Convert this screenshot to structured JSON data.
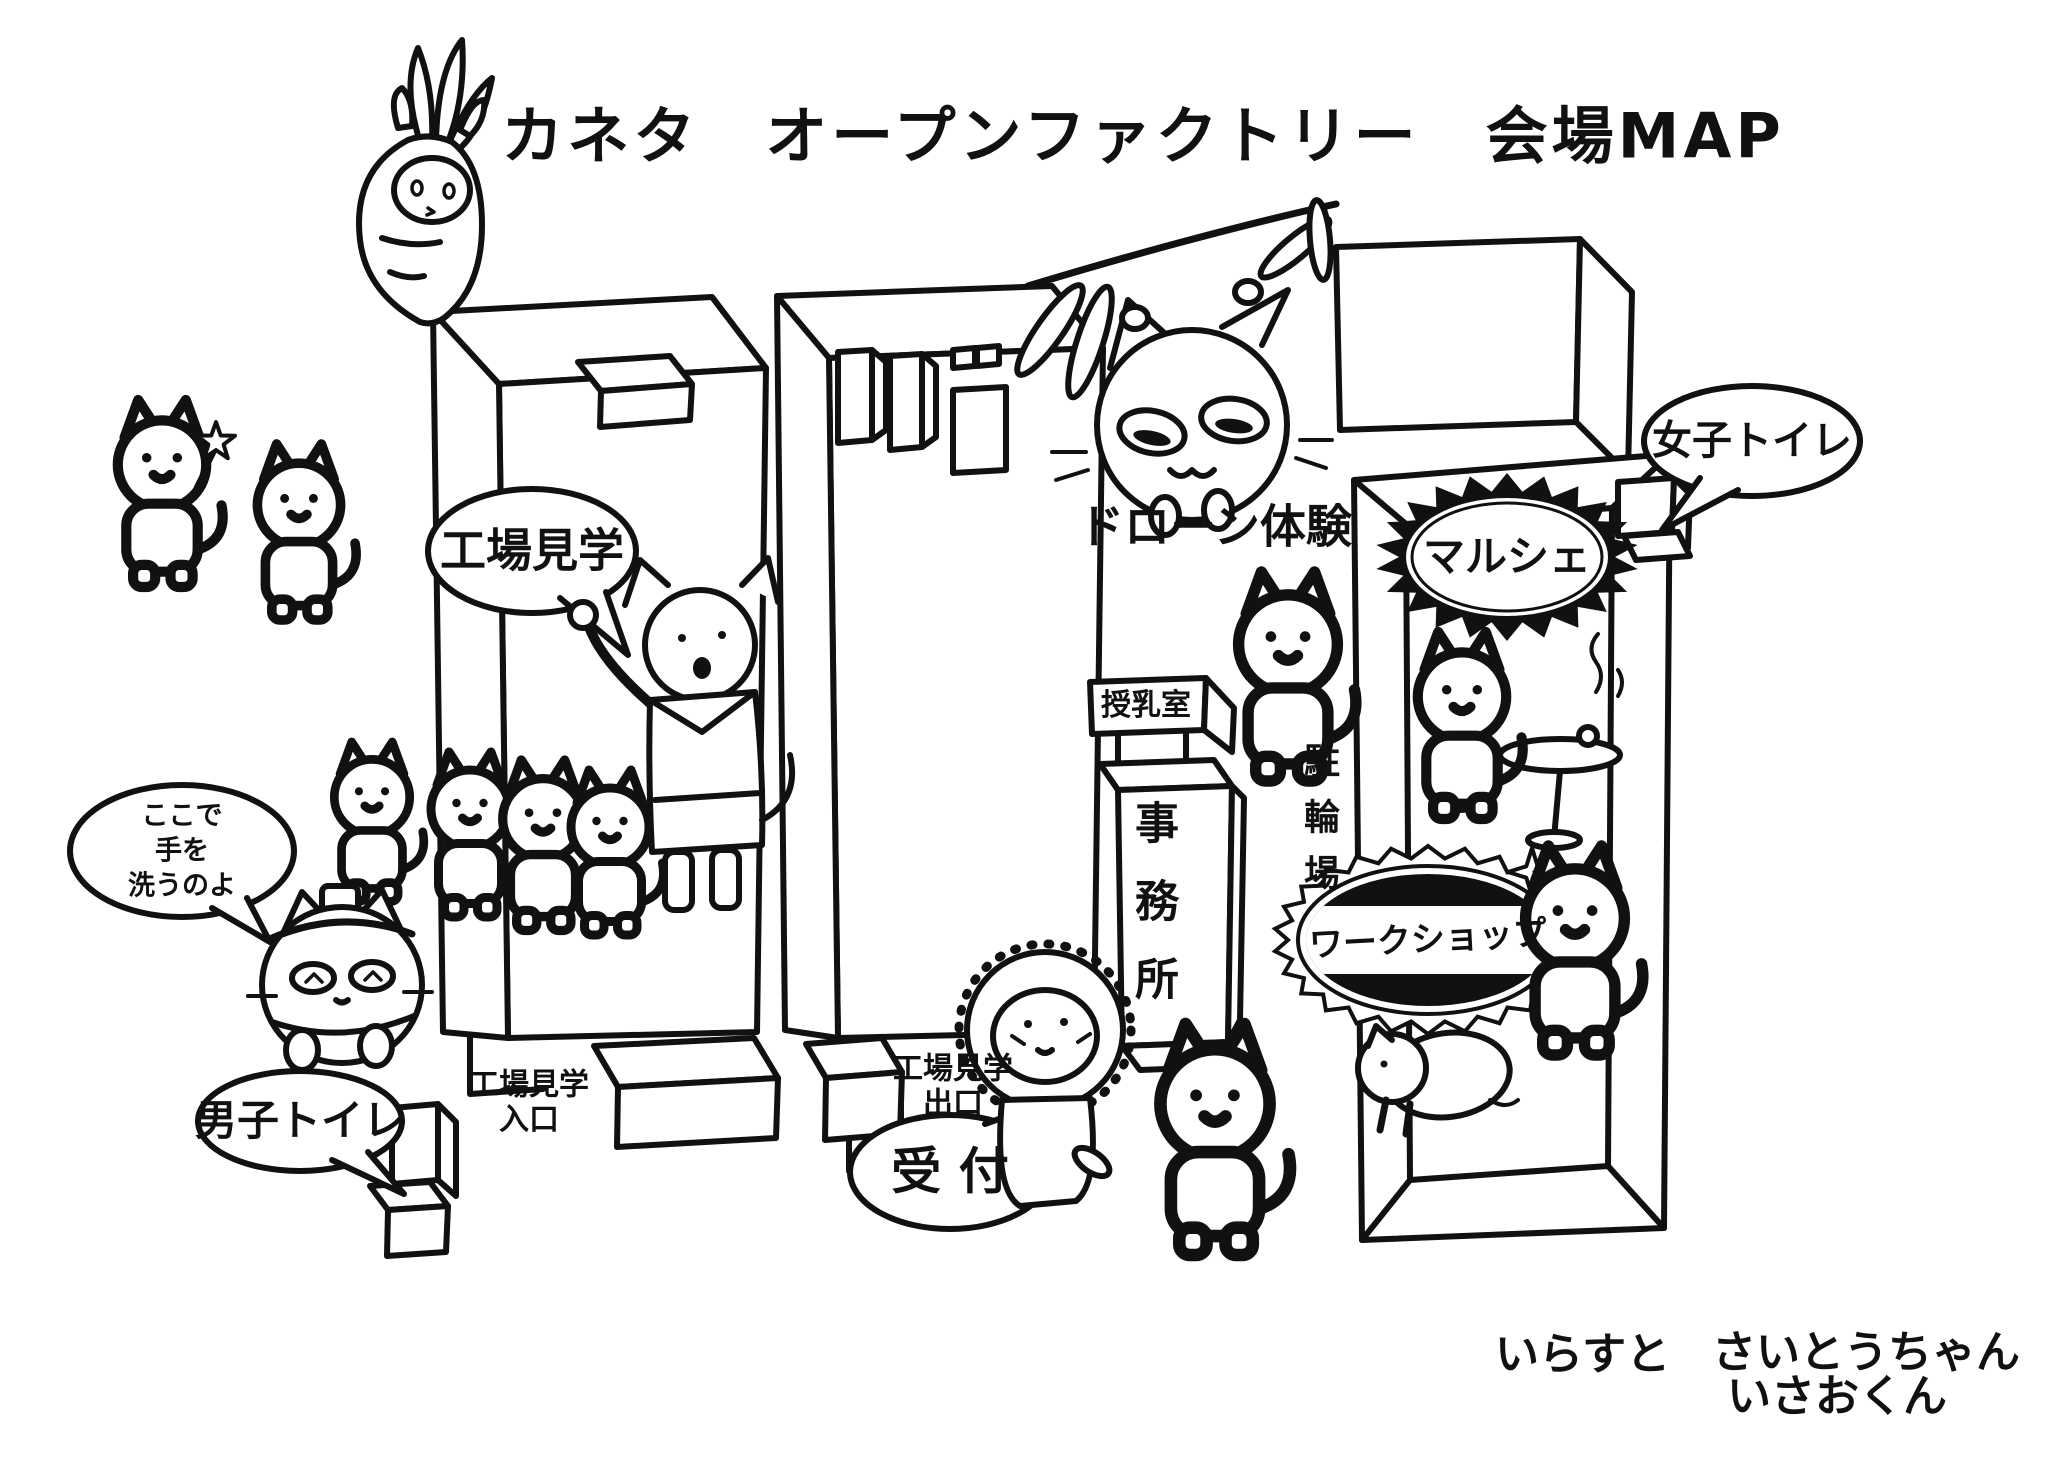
{
  "title": "カネタ　オープンファクトリー　会場MAP",
  "areas": {
    "factory_tour": "工場見学",
    "factory_tour_entrance": {
      "line1": "工場見学",
      "line2": "入口"
    },
    "factory_tour_exit": {
      "line1": "工場見学",
      "line2": "出口"
    },
    "reception": "受 付",
    "drone_experience": "ドローン体験",
    "nursing_room": "授乳室",
    "office": "事務所",
    "bicycle_parking": "駐輪場",
    "marche": "マルシェ",
    "workshop": "ワークショップ",
    "womens_toilet": "女子トイレ",
    "mens_toilet": "男子トイレ"
  },
  "speech": {
    "wash_hands_line1": "ここで",
    "wash_hands_line2": "手を",
    "wash_hands_line3": "洗うのよ"
  },
  "credits": {
    "label": "いらすと",
    "name1": "さいとうちゃん",
    "name2": "いさおくん"
  },
  "colors": {
    "ink": "#111111",
    "paper": "#ffffff"
  }
}
